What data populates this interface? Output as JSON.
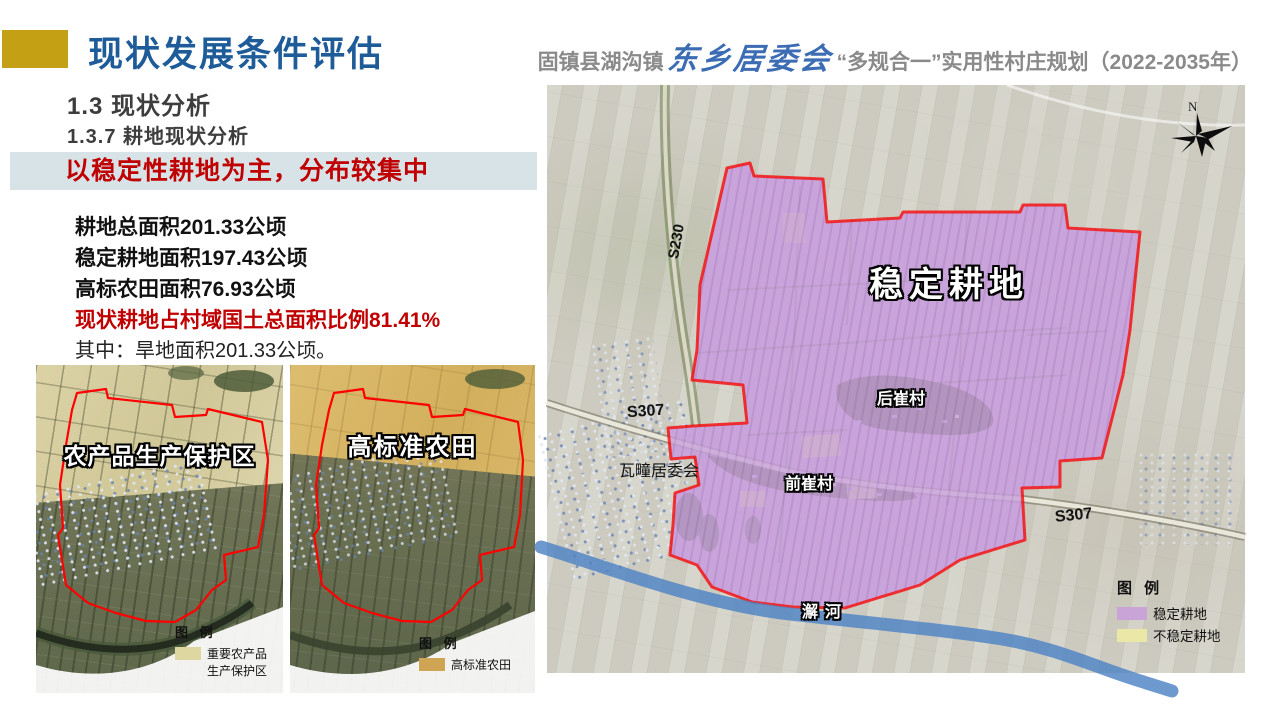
{
  "header": {
    "title": "现状发展条件评估",
    "subtitle_prefix": "固镇县湖沟镇",
    "subtitle_script": "东乡居委会",
    "subtitle_suffix": "“多规合一”实用性村庄规划（2022-2035年）"
  },
  "section": {
    "h1": "1.3  现状分析",
    "h2": "1.3.7  耕地现状分析"
  },
  "banner": {
    "text": "以稳定性耕地为主，分布较集中",
    "bg_color": "#d7e3e7",
    "text_color": "#c00000"
  },
  "stats": {
    "line1": "耕地总面积201.33公顷",
    "line2": "稳定耕地面积197.43公顷",
    "line3": "高标农田面积76.93公顷",
    "line4": "现状耕地占村域国土总面积比例81.41%",
    "line5": "其中：旱地面积201.33公顷。",
    "highlight_color": "#c00000"
  },
  "map_protection": {
    "title_label": "农产品生产保护区",
    "legend_title": "图 例",
    "legend_item_line1": "重要农产品",
    "legend_item_line2": "生产保护区",
    "legend_color": "#ded7a0",
    "boundary_color": "#ff0000"
  },
  "map_farmland": {
    "title_label": "高标准农田",
    "legend_title": "图 例",
    "legend_item": "高标准农田",
    "legend_color": "#cfa452",
    "boundary_color": "#ff0000"
  },
  "map_main": {
    "area_label": "稳定耕地",
    "road_s230": "S230",
    "road_s307_left": "S307",
    "road_s307_right": "S307",
    "town_label": "瓦疃居委会",
    "village_back": "后崔村",
    "village_front": "前崔村",
    "river_label": "澥河",
    "north_label": "N",
    "legend_title": "图 例",
    "legend_items": [
      {
        "label": "稳定耕地",
        "color": "#c9a4d6"
      },
      {
        "label": "不稳定耕地",
        "color": "#ebe7a6"
      }
    ],
    "area_fill_color": "#c9a3dc",
    "boundary_color": "#f50f0f",
    "river_color": "#4d82c4"
  }
}
